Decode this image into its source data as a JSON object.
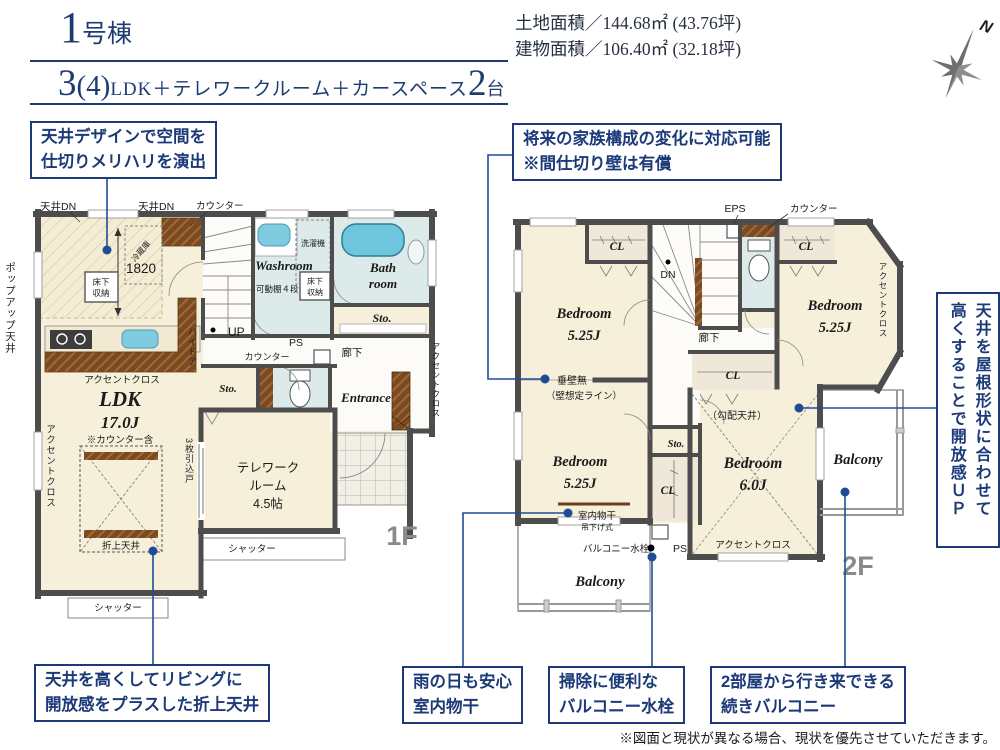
{
  "header": {
    "building_no_num": "1",
    "building_no_suffix": "号棟",
    "plan_num": "3",
    "plan_paren": "(4)",
    "plan_desc": "LDK＋テレワークルーム＋カースペース",
    "plan_cars_num": "2",
    "plan_cars_unit": "台",
    "land_area": "土地面積／144.68㎡ (43.76坪)",
    "building_area": "建物面積／106.40㎡ (32.18坪)",
    "compass_n": "N"
  },
  "callouts": {
    "ceiling_design": {
      "line1": "天井デザインで空間を",
      "line2": "仕切りメリハリを演出"
    },
    "future_family": {
      "line1": "将来の家族構成の変化に対応可能",
      "line2": "※間仕切り壁は有償"
    },
    "roof_shape": {
      "line1": "天井を屋根形状に合わせて",
      "line2": "高くすることで開放感ＵＰ"
    },
    "coffered_ceiling": {
      "line1": "天井を高くしてリビングに",
      "line2": "開放感をプラスした折上天井"
    },
    "indoor_drying": {
      "line1": "雨の日も安心",
      "line2": "室内物干"
    },
    "balcony_faucet": {
      "line1": "掃除に便利な",
      "line2": "バルコニー水栓"
    },
    "connected_balcony": {
      "line1": "2部屋から行き来できる",
      "line2": "続きバルコニー"
    }
  },
  "floor1": {
    "floor_label": "1F",
    "ceiling_dn_left": "天井DN",
    "ceiling_dn_right": "天井DN",
    "counter_top": "カウンター",
    "counter_mid": "カウンター",
    "fridge": "冷蔵庫",
    "dim_1820": "1820",
    "underfloor_k1": "床下",
    "underfloor_k2": "収納",
    "underfloor_w1": "床下",
    "underfloor_w2": "収納",
    "popup_ceiling": "ポップアップ天井",
    "accent_kitchen": "アクセントクロス",
    "accent_ldk": "アクセントクロス",
    "accent_entrance": "アクセントクロス",
    "ldk": "LDK",
    "ldk_size": "17.0J",
    "ldk_note": "※カウンター含",
    "oriage_ceiling": "折上天井",
    "shutter_ldk": "シャッター",
    "shutter_telework": "シャッター",
    "high_door": "ハイドア",
    "sliding_door": "3枚引込戸",
    "up": "UP",
    "ps": "PS",
    "hallway": "廊下",
    "washroom": "Washroom",
    "washer": "洗濯機",
    "shelf": "可動棚４段",
    "bath1": "Bath",
    "bath2": "room",
    "sto_bath": "Sto.",
    "sto_hall": "Sto.",
    "telework1": "テレワーク",
    "telework2": "ルーム",
    "telework3": "4.5帖",
    "entrance": "Entrance"
  },
  "floor2": {
    "floor_label": "2F",
    "eps": "EPS",
    "counter": "カウンター",
    "cl_bed1": "CL",
    "cl_bed3": "CL",
    "cl_center": "CL",
    "cl_bed4": "CL",
    "dn": "DN",
    "hallway": "廊下",
    "bed1": "Bedroom",
    "bed1_size": "5.25J",
    "bed2": "Bedroom",
    "bed2_size": "5.25J",
    "bed3": "Bedroom",
    "bed3_size": "5.25J",
    "bed4": "Bedroom",
    "bed4_size": "6.0J",
    "no_hanging_wall": "垂壁無",
    "wall_line_note": "（壁想定ライン）",
    "sloped_ceiling": "（勾配天井）",
    "sto": "Sto.",
    "indoor_drying": "室内物干",
    "hanging_type": "吊下げ式",
    "balcony_faucet": "バルコニー水栓",
    "ps": "PS",
    "accent_bed3": "アクセントクロス",
    "accent_bed4": "アクセントクロス",
    "balcony_bottom": "Balcony",
    "balcony_right": "Balcony"
  },
  "disclaimer": "※図面と現状が異なる場合、現状を優先させていただきます。"
}
